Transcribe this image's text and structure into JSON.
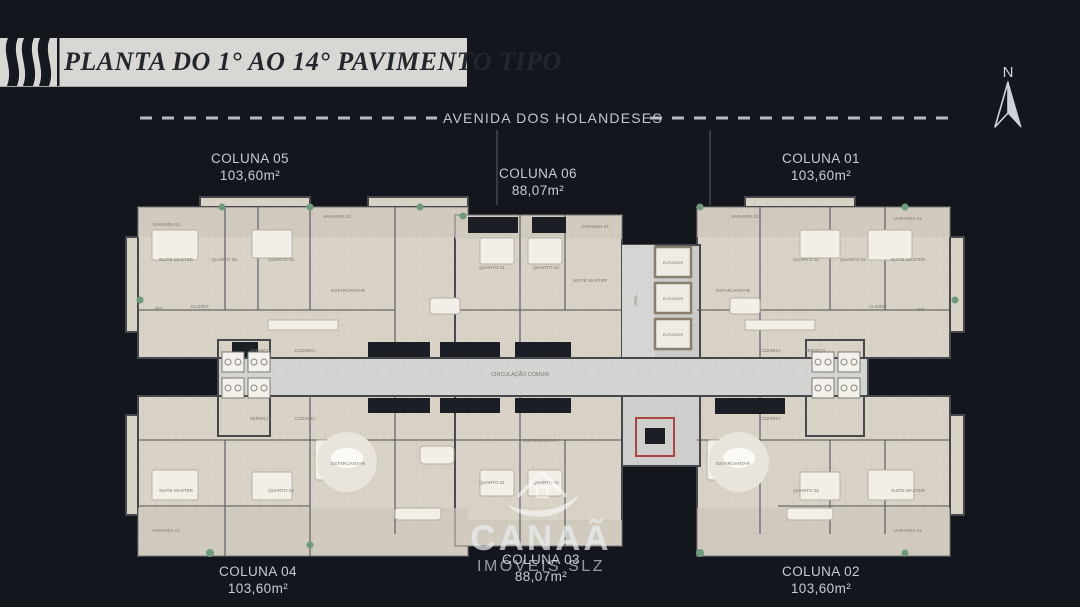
{
  "header": {
    "title": "PLANTA DO 1° AO 14° PAVIMENTO TIPO"
  },
  "street": {
    "name": "AVENIDA DOS HOLANDESES"
  },
  "north": {
    "label": "N"
  },
  "units": [
    {
      "id": "coluna-05",
      "name": "COLUNA 05",
      "area": "103,60m²"
    },
    {
      "id": "coluna-06",
      "name": "COLUNA 06",
      "area": "88,07m²"
    },
    {
      "id": "coluna-01",
      "name": "COLUNA 01",
      "area": "103,60m²"
    },
    {
      "id": "coluna-04",
      "name": "COLUNA 04",
      "area": "103,60m²"
    },
    {
      "id": "coluna-03",
      "name": "COLUNA 03",
      "area": "88,07m²"
    },
    {
      "id": "coluna-02",
      "name": "COLUNA 02",
      "area": "103,60m²"
    }
  ],
  "watermark": {
    "brand": "CANAÃ",
    "sub": "IMÓVEIS SLZ"
  },
  "plan": {
    "room_labels": [
      {
        "text": "VARANDA 01",
        "x": 166,
        "y": 226
      },
      {
        "text": "VARANDA 02",
        "x": 337,
        "y": 218
      },
      {
        "text": "VARANDA 01",
        "x": 595,
        "y": 228
      },
      {
        "text": "VARANDA 02",
        "x": 745,
        "y": 218
      },
      {
        "text": "VARANDA 01",
        "x": 908,
        "y": 220
      },
      {
        "text": "SUITE MASTER",
        "x": 176,
        "y": 261
      },
      {
        "text": "QUARTO 03",
        "x": 224,
        "y": 261
      },
      {
        "text": "QUARTO 02",
        "x": 281,
        "y": 261
      },
      {
        "text": "ESTAR/JANTAR",
        "x": 348,
        "y": 292
      },
      {
        "text": "QUARTO 01",
        "x": 492,
        "y": 269
      },
      {
        "text": "QUARTO 02",
        "x": 546,
        "y": 269
      },
      {
        "text": "SUITE MASTER",
        "x": 590,
        "y": 282
      },
      {
        "text": "ESTAR/JANTAR",
        "x": 733,
        "y": 292
      },
      {
        "text": "QUARTO 02",
        "x": 806,
        "y": 261
      },
      {
        "text": "QUARTO 03",
        "x": 853,
        "y": 261
      },
      {
        "text": "SUITE MASTER",
        "x": 908,
        "y": 261
      },
      {
        "text": "CLOSET",
        "x": 200,
        "y": 308
      },
      {
        "text": "WC",
        "x": 159,
        "y": 310
      },
      {
        "text": "CLOSET",
        "x": 878,
        "y": 308
      },
      {
        "text": "WC",
        "x": 921,
        "y": 311
      },
      {
        "text": "SERVIÇO",
        "x": 260,
        "y": 352
      },
      {
        "text": "COZINHA",
        "x": 305,
        "y": 352
      },
      {
        "text": "COZINHA",
        "x": 770,
        "y": 352
      },
      {
        "text": "SERVIÇO",
        "x": 815,
        "y": 352
      },
      {
        "text": "CIRCULAÇÃO COMUM",
        "x": 520,
        "y": 376,
        "size": 5.4
      },
      {
        "text": "ELEVADOR",
        "x": 673,
        "y": 264,
        "size": 3.8
      },
      {
        "text": "ELEVADOR",
        "x": 673,
        "y": 300,
        "size": 3.8
      },
      {
        "text": "ELEVADOR",
        "x": 673,
        "y": 336,
        "size": 3.8
      },
      {
        "text": "HALL",
        "x": 637,
        "y": 300,
        "rotate": -90
      },
      {
        "text": "SERVIÇO",
        "x": 260,
        "y": 420
      },
      {
        "text": "COZINHA",
        "x": 305,
        "y": 420
      },
      {
        "text": "COZINHA",
        "x": 770,
        "y": 420
      },
      {
        "text": "ESTAR/JANTAR",
        "x": 348,
        "y": 465
      },
      {
        "text": "ESTAR/JANTAR",
        "x": 540,
        "y": 442
      },
      {
        "text": "ESTAR/JANTAR",
        "x": 733,
        "y": 465
      },
      {
        "text": "SUITE MASTER",
        "x": 176,
        "y": 492
      },
      {
        "text": "QUARTO 02",
        "x": 281,
        "y": 492
      },
      {
        "text": "QUARTO 01",
        "x": 492,
        "y": 484
      },
      {
        "text": "QUARTO 02",
        "x": 546,
        "y": 484
      },
      {
        "text": "QUARTO 02",
        "x": 806,
        "y": 492
      },
      {
        "text": "SUITE MASTER",
        "x": 908,
        "y": 492
      },
      {
        "text": "VARANDA 01",
        "x": 166,
        "y": 532
      },
      {
        "text": "VARANDA 01",
        "x": 908,
        "y": 532
      }
    ]
  },
  "colors": {
    "background": "#14161d",
    "banner_bg": "#d8d7d3",
    "banner_text": "#23262c",
    "plan_floor": "#d8d2c7",
    "plan_wall": "#46474b",
    "corridor": "#d4d4d2",
    "stair_accent_red": "#a9463f",
    "balcony_plant_green": "#6f9a7d",
    "label_gray": "#c8ccd2"
  }
}
